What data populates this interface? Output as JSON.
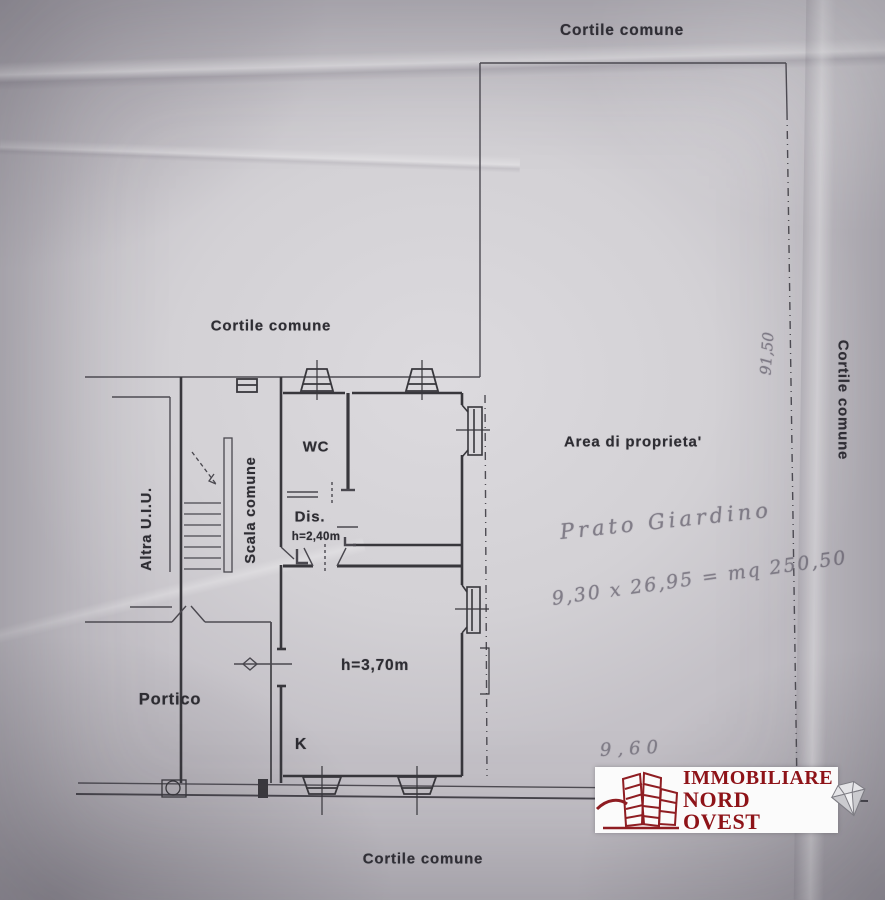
{
  "plan": {
    "courtyard_label": "Cortile comune",
    "property_label": "Area di proprieta'",
    "room_wc": "WC",
    "room_dis": "Dis.",
    "room_kitchen": "K",
    "room_portico": "Portico",
    "stairs_label": "Scala comune",
    "other_unit_label": "Altra U.I.U.",
    "height_dis": "h=2,40m",
    "height_main": "h=3,70m"
  },
  "handwriting": {
    "garden_note": "Prato Giardino",
    "area_calc": "9,30 x 26,95 = mq 250,50",
    "side_measure": "91,50",
    "bottom_measure": "9,60"
  },
  "logo": {
    "line1": "IMMOBILIARE",
    "line2": "NORD OVEST",
    "brand_red": "#8e1318"
  },
  "colors": {
    "paper": "#d3d1d5",
    "ink": "#2f2e34",
    "pencil": "#817d88"
  }
}
